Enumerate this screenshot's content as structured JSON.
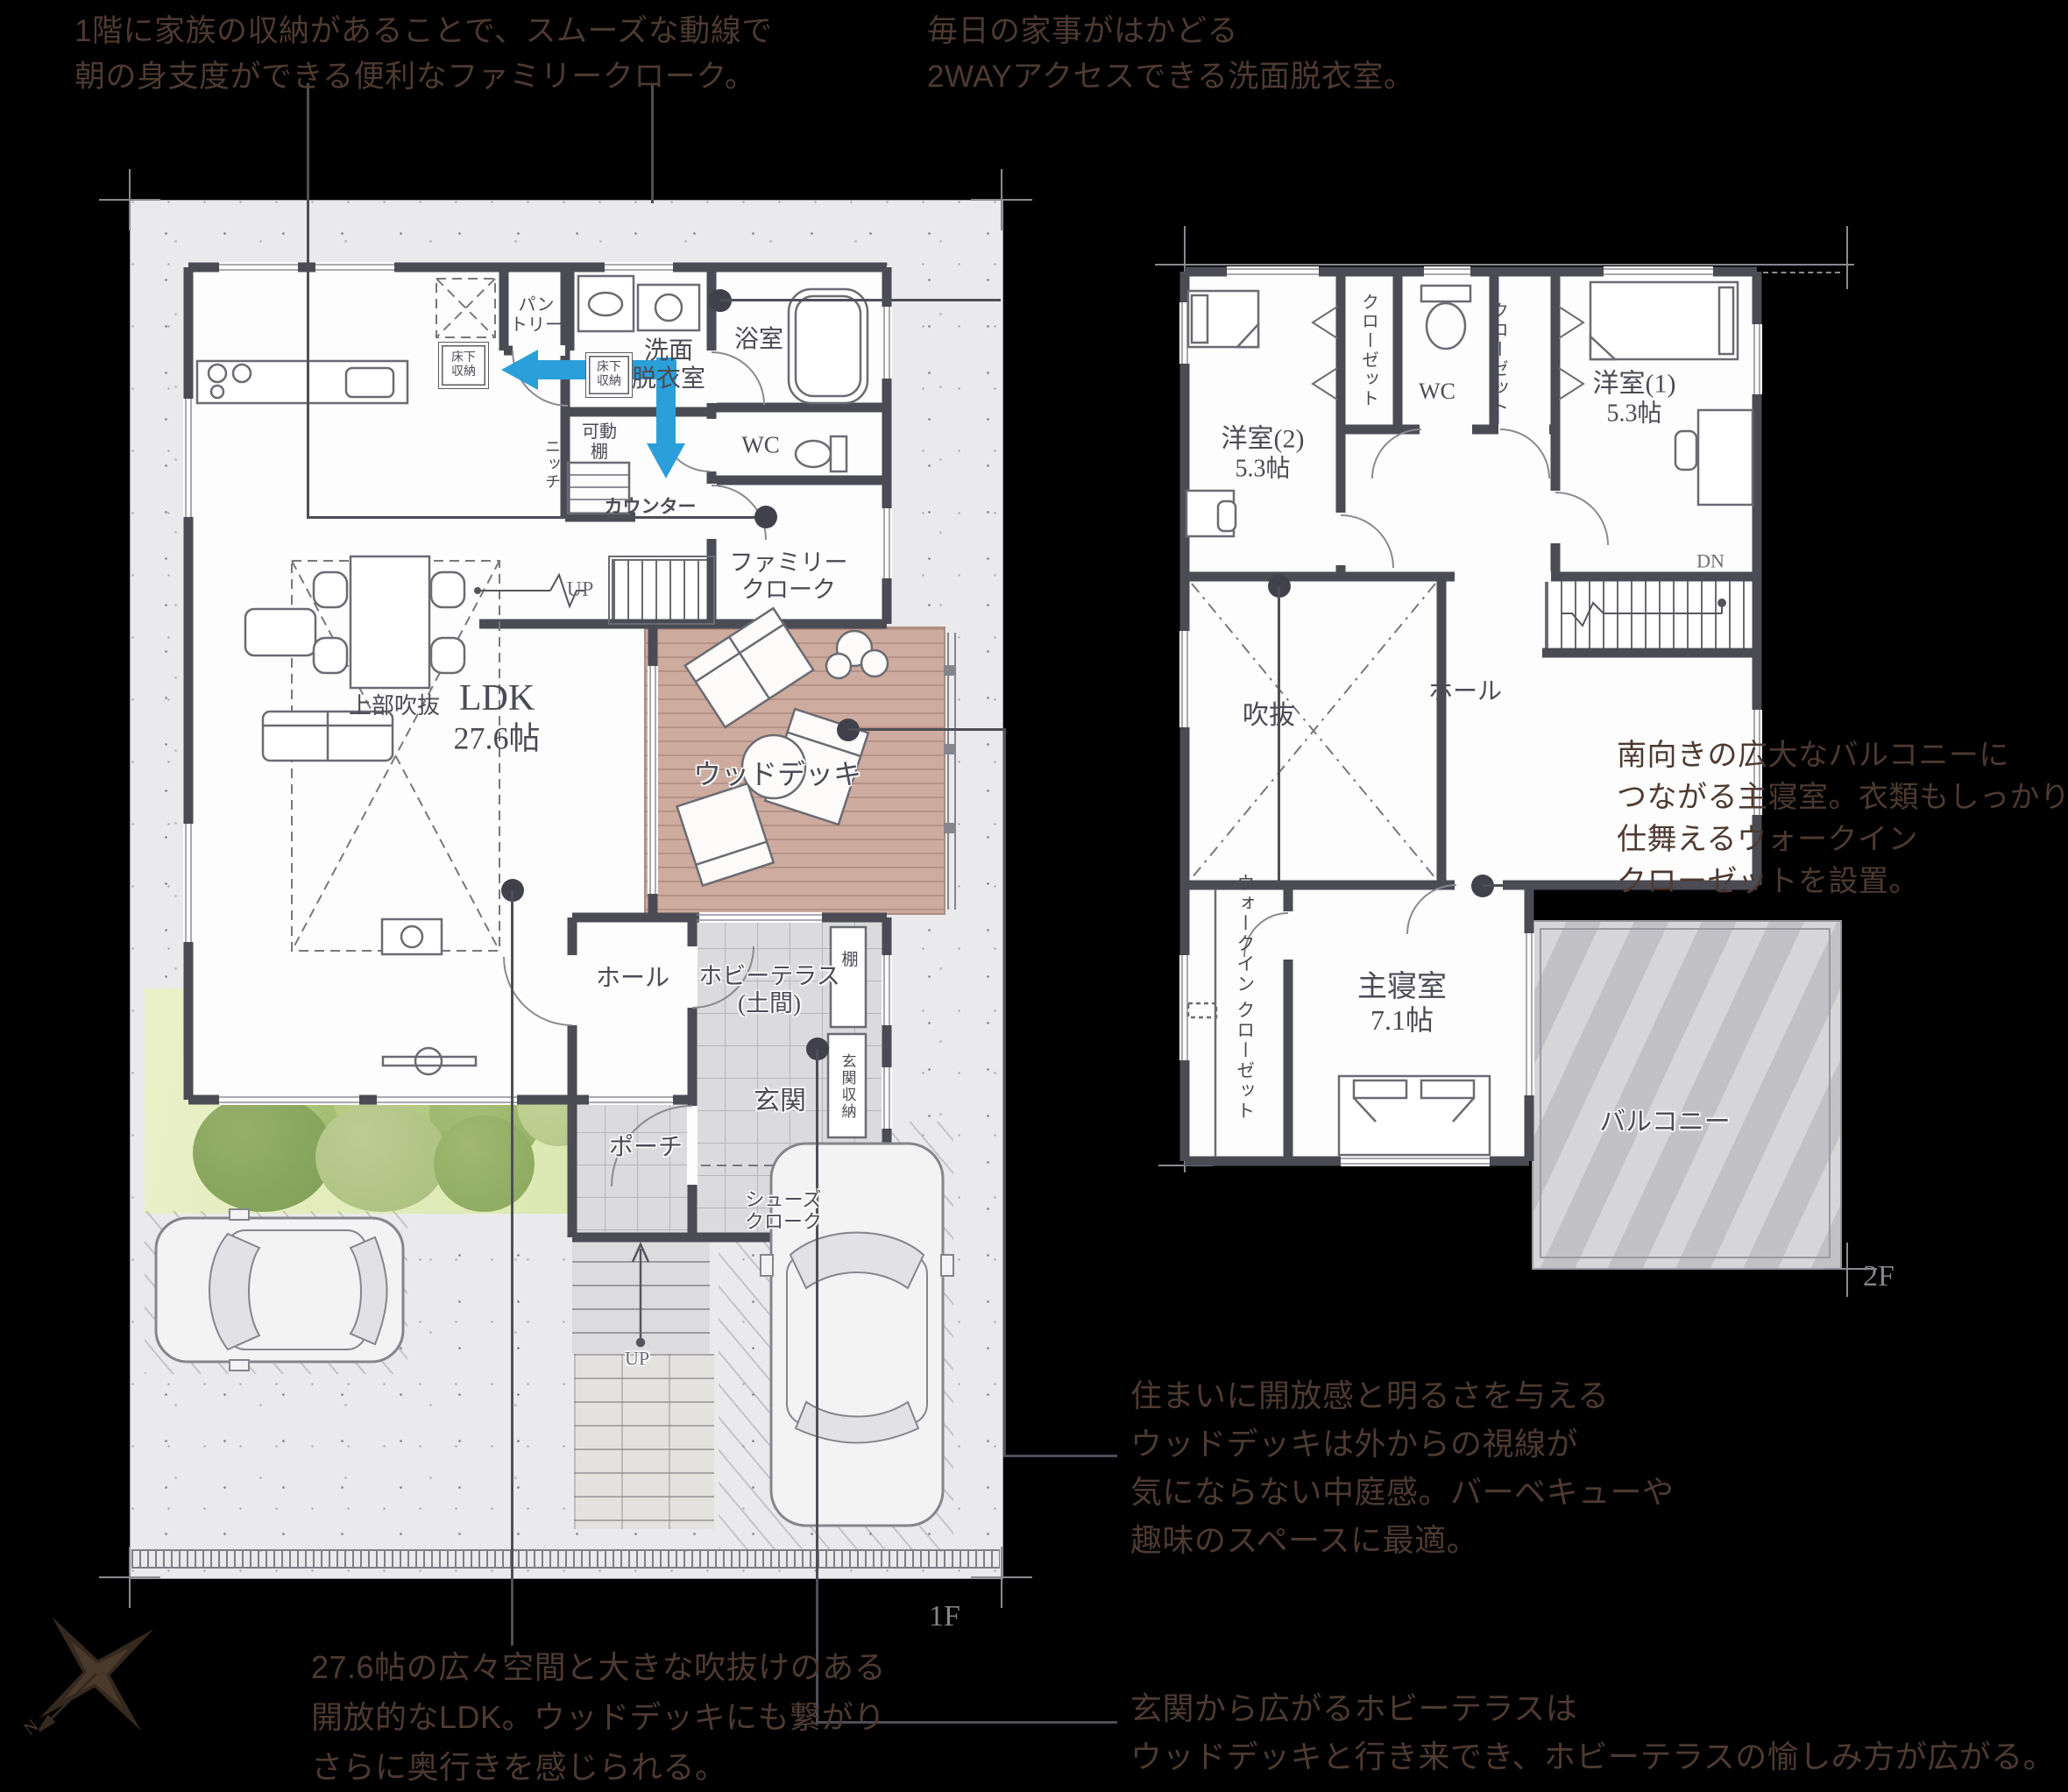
{
  "annotations": {
    "family_cloak": [
      "1階に家族の収納があることで、スムーズな動線で",
      "朝の身支度ができる便利なファミリークローク。"
    ],
    "washroom": [
      "毎日の家事がはかどる",
      "2WAYアクセスできる洗面脱衣室。"
    ],
    "master_bedroom": [
      "南向きの広大なバルコニーに",
      "つながる主寝室。衣類もしっかり",
      "仕舞えるウォークイン",
      "クローゼットを設置。"
    ],
    "wood_deck": [
      "住まいに開放感と明るさを与える",
      "ウッドデッキは外からの視線が",
      "気にならない中庭感。バーベキューや",
      "趣味のスペースに最適。"
    ],
    "hobby_terrace": [
      "玄関から広がるホビーテラスは",
      "ウッドデッキと行き来でき、ホビーテラスの愉しみ方が広がる。"
    ],
    "ldk": [
      "27.6帖の広々空間と大きな吹抜けのある",
      "開放的なLDK。ウッドデッキにも繋がり",
      "さらに奥行きを感じられる。"
    ]
  },
  "floor1": {
    "tag": "1F",
    "labels": {
      "pantry": [
        "パン",
        "トリー"
      ],
      "floor_storage": [
        "床下",
        "収納"
      ],
      "washroom": [
        "洗面",
        "脱衣室"
      ],
      "bath": "浴室",
      "wc": "WC",
      "niche": "ニッチ",
      "movable_shelf": [
        "可動",
        "棚"
      ],
      "counter": "カウンター",
      "family_cloak": [
        "ファミリー",
        "クローク"
      ],
      "up_stairs": "UP",
      "ldk": "LDK",
      "ldk_size": "27.6帖",
      "void_above": "上部吹抜",
      "wood_deck": "ウッドデッキ",
      "hall": "ホール",
      "hobby_terrace": [
        "ホビーテラス",
        "(土間)"
      ],
      "shelf": "棚",
      "entrance": "玄関",
      "entrance_storage": "玄関収納",
      "porch": "ポーチ",
      "shoes_cloak": [
        "シューズ",
        "クローク"
      ],
      "up_approach": "UP"
    }
  },
  "floor2": {
    "tag": "2F",
    "labels": {
      "room2": [
        "洋室(2)",
        "5.3帖"
      ],
      "room1": [
        "洋室(1)",
        "5.3帖"
      ],
      "closet": "クローゼット",
      "wc": "WC",
      "down_stairs": "DN",
      "void": "吹抜",
      "hall": "ホール",
      "wic": [
        "ウォークイン",
        "クローゼット"
      ],
      "master": [
        "主寝室",
        "7.1帖"
      ],
      "balcony": "バルコニー"
    }
  },
  "compass": {
    "north": "N"
  },
  "colors": {
    "wall": "#4b4b54",
    "arrow": "#2b9fd9",
    "deck": "#cdab9e",
    "annotation_text": "#4d3a31",
    "leader": "#4e4e57"
  }
}
